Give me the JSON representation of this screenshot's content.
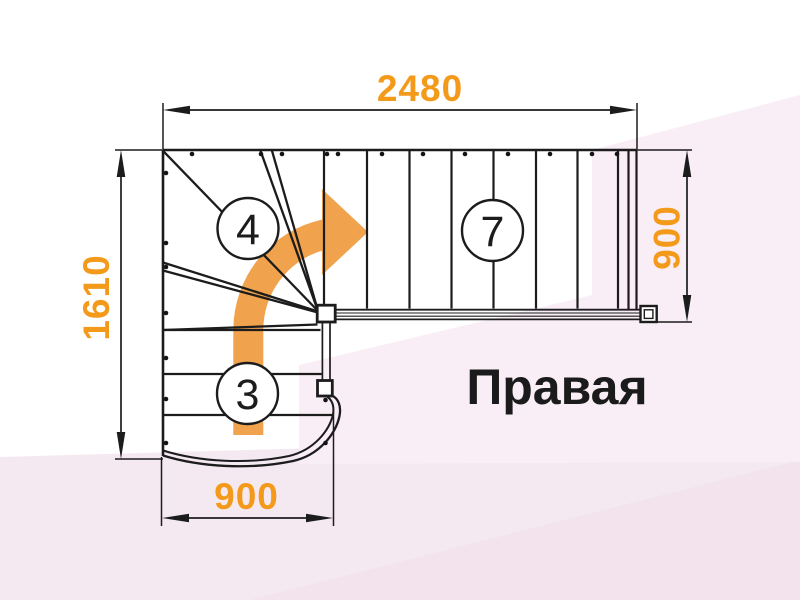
{
  "title": {
    "text": "Правая"
  },
  "dimensions": {
    "top": {
      "value": "2480"
    },
    "left": {
      "value": "1610"
    },
    "right": {
      "value": "900"
    },
    "bottom": {
      "value": "900"
    }
  },
  "step_counts": {
    "winder_flight": "4",
    "upper_flight": "7",
    "lower_flight": "3"
  },
  "icons": {
    "direction_arrow": "curved-right-turn-arrow"
  },
  "colors": {
    "accent_orange": "#F39A1B",
    "arrow_orange": "#F0A24C",
    "ink": "#1C1C1C",
    "bg_pink_right": "#F9EEF6",
    "bg_pink_bottom": "#F5E9F1",
    "bg_pink_corner": "#F2E3ED"
  }
}
